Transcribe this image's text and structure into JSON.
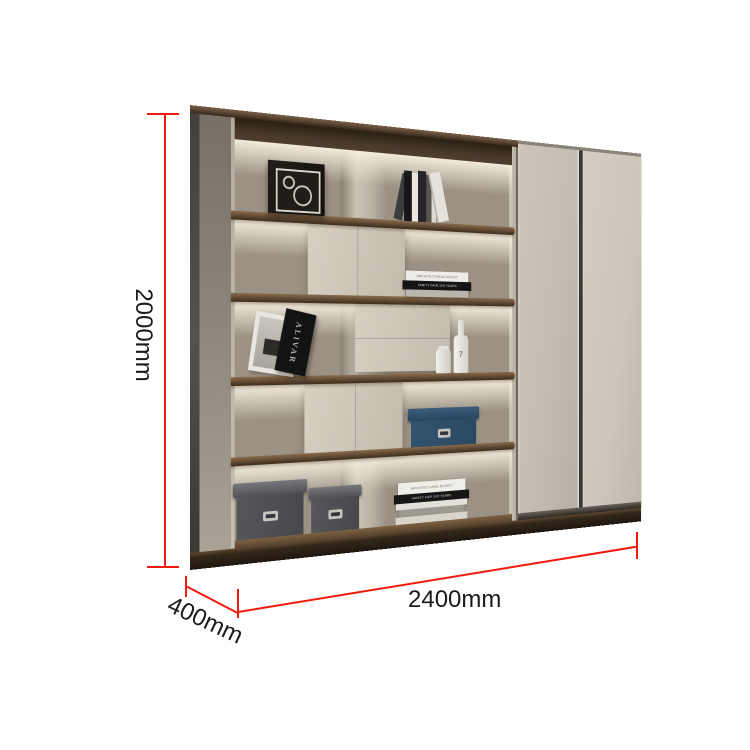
{
  "annotations": {
    "height_label": "2000mm",
    "width_label": "2400mm",
    "depth_label": "400mm",
    "line_color": "#f2190e",
    "text_color": "#1b1b1b"
  },
  "decor": {
    "shelf_stack_top_book": "ARCHITECTURAL DIGEST",
    "shelf_stack_black_book": "VANITY FAIR 100 YEARS",
    "bottom_stack_top_book": "ARCHITECTURAL DIGEST",
    "bottom_stack_black_book": "VANITY FAIR 100 YEARS",
    "art_frame_text": "ALIVAR",
    "bottle_text": "7"
  },
  "palette": {
    "walnut_wood": "#5f4832",
    "greige_panel": "#cbc4b7",
    "back_wall": "#9b9285",
    "door_face": "#cbc5ba",
    "navy_box": "#2e4d68",
    "grey_box": "#4e4f51",
    "accent_red": "#f2190e"
  }
}
